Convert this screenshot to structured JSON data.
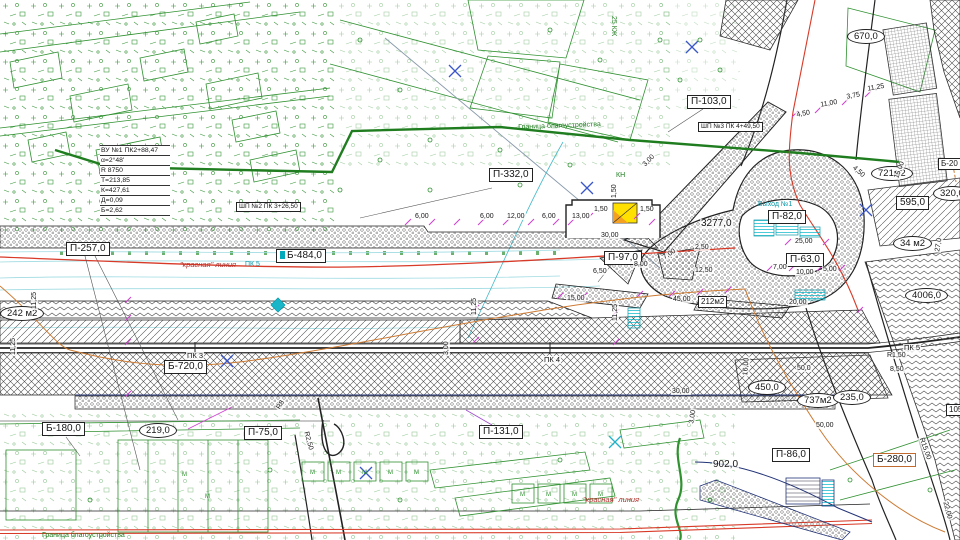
{
  "colors": {
    "survey_green": "#2f9130",
    "red_line": "#d83a28",
    "orange_line": "#cd7a32",
    "magenta_tick": "#d040d0",
    "teal": "#0996a8",
    "navy": "#223377",
    "yellow": "#ffe000"
  },
  "curve_table": {
    "rows": [
      "ВУ №1 ПК2+88,47",
      "α=2°48'",
      "R 8750",
      "Т=213,85",
      "К=427,61",
      "Д=0,09",
      "Б=2,62"
    ]
  },
  "labels": [
    {
      "t": "П-257,0",
      "x": 66,
      "y": 242,
      "c": "boxed"
    },
    {
      "t": "Б-484,0",
      "x": 276,
      "y": 249,
      "c": "boxed flag"
    },
    {
      "t": "П-332,0",
      "x": 489,
      "y": 168,
      "c": "boxed"
    },
    {
      "t": "П-103,0",
      "x": 687,
      "y": 95,
      "c": "boxed"
    },
    {
      "t": "ШП №3 ПК 4+49,50",
      "x": 698,
      "y": 122,
      "c": "boxed tiny"
    },
    {
      "t": "ШП №2 ПК 3+26,50",
      "x": 236,
      "y": 202,
      "c": "boxed tiny"
    },
    {
      "t": "П-82,0",
      "x": 768,
      "y": 210,
      "c": "boxed"
    },
    {
      "t": "П-63,0",
      "x": 786,
      "y": 253,
      "c": "boxed"
    },
    {
      "t": "П-97,0",
      "x": 604,
      "y": 251,
      "c": "boxed"
    },
    {
      "t": "Б-720,0",
      "x": 164,
      "y": 360,
      "c": "boxed"
    },
    {
      "t": "Б-180,0",
      "x": 42,
      "y": 422,
      "c": "boxed"
    },
    {
      "t": "П-75,0",
      "x": 244,
      "y": 426,
      "c": "boxed"
    },
    {
      "t": "П-131,0",
      "x": 479,
      "y": 425,
      "c": "boxed"
    },
    {
      "t": "П-86,0",
      "x": 772,
      "y": 448,
      "c": "boxed"
    },
    {
      "t": "Б-280,0",
      "x": 873,
      "y": 453,
      "c": "boxed ob"
    },
    {
      "t": "595,0",
      "x": 896,
      "y": 196,
      "c": "boxed"
    },
    {
      "t": "212м2",
      "x": 698,
      "y": 296,
      "c": "boxed small"
    },
    {
      "t": "105,0",
      "x": 946,
      "y": 404,
      "c": "boxed small"
    },
    {
      "t": "Б-20",
      "x": 938,
      "y": 158,
      "c": "boxed small"
    },
    {
      "t": "219,0",
      "x": 139,
      "y": 423,
      "c": "ellipse"
    },
    {
      "t": "450,0",
      "x": 748,
      "y": 380,
      "c": "ellipse"
    },
    {
      "t": "737м2",
      "x": 797,
      "y": 393,
      "c": "ellipse"
    },
    {
      "t": "235,0",
      "x": 833,
      "y": 390,
      "c": "ellipse"
    },
    {
      "t": "721м2",
      "x": 871,
      "y": 166,
      "c": "ellipse"
    },
    {
      "t": "34 м2",
      "x": 893,
      "y": 236,
      "c": "ellipse"
    },
    {
      "t": "4006,0",
      "x": 905,
      "y": 288,
      "c": "ellipse"
    },
    {
      "t": "670,0",
      "x": 847,
      "y": 29,
      "c": "ellipse"
    },
    {
      "t": "242 м2",
      "x": 0,
      "y": 306,
      "c": "ellipse"
    },
    {
      "t": "320,0",
      "x": 933,
      "y": 186,
      "c": "ellipse"
    },
    {
      "t": "902,0",
      "x": 712,
      "y": 460,
      "c": "plain strong"
    },
    {
      "t": "3277,0",
      "x": 700,
      "y": 219,
      "c": "plain strong"
    },
    {
      "t": "\"красная\" линия",
      "x": 180,
      "y": 260,
      "c": "redtext"
    },
    {
      "t": "ПК 5",
      "x": 245,
      "y": 260,
      "c": "tealtext"
    },
    {
      "t": "\"красная\" линия",
      "x": 583,
      "y": 495,
      "c": "redtext"
    },
    {
      "t": "Выход №1",
      "x": 758,
      "y": 200,
      "c": "tealtext"
    },
    {
      "t": "КН",
      "x": 616,
      "y": 171,
      "c": "greentext"
    },
    {
      "t": "25 КЖ",
      "x": 618,
      "y": 16,
      "c": "greentext",
      "r": 90
    },
    {
      "t": "Граница благоустройства",
      "x": 518,
      "y": 123,
      "c": "greentext",
      "r": -2
    },
    {
      "t": "Граница благоустройства",
      "x": 42,
      "y": 531,
      "c": "greentext"
    },
    {
      "t": "ПК 3",
      "x": 186,
      "y": 352,
      "c": "station"
    },
    {
      "t": "ПК 4",
      "x": 543,
      "y": 356,
      "c": "station"
    },
    {
      "t": "ПК 5",
      "x": 903,
      "y": 344,
      "c": "station"
    },
    {
      "t": "6,00",
      "x": 414,
      "y": 213,
      "c": "dim"
    },
    {
      "t": "6,00",
      "x": 479,
      "y": 213,
      "c": "dim"
    },
    {
      "t": "12,00",
      "x": 506,
      "y": 213,
      "c": "dim"
    },
    {
      "t": "6,00",
      "x": 541,
      "y": 213,
      "c": "dim"
    },
    {
      "t": "13,00",
      "x": 571,
      "y": 213,
      "c": "dim"
    },
    {
      "t": "1,50",
      "x": 593,
      "y": 206,
      "c": "dim"
    },
    {
      "t": "1,50",
      "x": 639,
      "y": 206,
      "c": "dim"
    },
    {
      "t": "1,50",
      "x": 611,
      "y": 199,
      "c": "dim",
      "r": -90
    },
    {
      "t": "30,00",
      "x": 600,
      "y": 232,
      "c": "dim"
    },
    {
      "t": "45,00",
      "x": 672,
      "y": 296,
      "c": "dim"
    },
    {
      "t": "15,00",
      "x": 566,
      "y": 295,
      "c": "dim"
    },
    {
      "t": "20,00",
      "x": 788,
      "y": 299,
      "c": "dim"
    },
    {
      "t": "12,50",
      "x": 694,
      "y": 267,
      "c": "dim"
    },
    {
      "t": "6,50",
      "x": 592,
      "y": 268,
      "c": "dim"
    },
    {
      "t": "8,00",
      "x": 633,
      "y": 261,
      "c": "dim"
    },
    {
      "t": "7,00",
      "x": 661,
      "y": 256,
      "c": "dim",
      "r": -35
    },
    {
      "t": "2,50",
      "x": 694,
      "y": 244,
      "c": "dim"
    },
    {
      "t": "7,00",
      "x": 772,
      "y": 264,
      "c": "dim"
    },
    {
      "t": "25,00",
      "x": 794,
      "y": 238,
      "c": "dim"
    },
    {
      "t": "10,00",
      "x": 795,
      "y": 269,
      "c": "dim"
    },
    {
      "t": "5,00",
      "x": 822,
      "y": 266,
      "c": "dim"
    },
    {
      "t": "4,50",
      "x": 795,
      "y": 112,
      "c": "dim",
      "r": -10
    },
    {
      "t": "11,00",
      "x": 819,
      "y": 102,
      "c": "dim",
      "r": -10
    },
    {
      "t": "3,75",
      "x": 845,
      "y": 94,
      "c": "dim",
      "r": -10
    },
    {
      "t": "11,25",
      "x": 866,
      "y": 86,
      "c": "dim",
      "r": -10
    },
    {
      "t": "R1,50",
      "x": 886,
      "y": 352,
      "c": "dim"
    },
    {
      "t": "8,50",
      "x": 889,
      "y": 366,
      "c": "dim"
    },
    {
      "t": "R15,00",
      "x": 924,
      "y": 436,
      "c": "dim",
      "r": 70
    },
    {
      "t": "22,00",
      "x": 948,
      "y": 500,
      "c": "dim",
      "r": 75
    },
    {
      "t": "27,0",
      "x": 934,
      "y": 252,
      "c": "dim",
      "r": -80
    },
    {
      "t": "15,00",
      "x": 893,
      "y": 178,
      "c": "dim",
      "r": -70
    },
    {
      "t": "4,50",
      "x": 855,
      "y": 164,
      "c": "dim",
      "r": 42
    },
    {
      "t": "3,00",
      "x": 641,
      "y": 164,
      "c": "dim",
      "r": -46
    },
    {
      "t": "16,00",
      "x": 742,
      "y": 376,
      "c": "dim",
      "r": -85
    },
    {
      "t": "3,00",
      "x": 688,
      "y": 424,
      "c": "dim",
      "r": -80
    },
    {
      "t": "30,00",
      "x": 671,
      "y": 388,
      "c": "dim"
    },
    {
      "t": "50,0",
      "x": 796,
      "y": 365,
      "c": "dim"
    },
    {
      "t": "50,00",
      "x": 815,
      "y": 422,
      "c": "dim"
    },
    {
      "t": "11,25",
      "x": 10,
      "y": 356,
      "c": "dim",
      "r": -90
    },
    {
      "t": "11,25",
      "x": 31,
      "y": 310,
      "c": "dim",
      "r": -90
    },
    {
      "t": "11,25",
      "x": 471,
      "y": 316,
      "c": "dim",
      "r": -90
    },
    {
      "t": "11,25",
      "x": 612,
      "y": 322,
      "c": "dim",
      "r": -90
    },
    {
      "t": "3,00",
      "x": 443,
      "y": 356,
      "c": "dim",
      "r": -90
    },
    {
      "t": "R8",
      "x": 275,
      "y": 408,
      "c": "dim",
      "r": -60
    },
    {
      "t": "R2,50",
      "x": 309,
      "y": 430,
      "c": "dim",
      "r": 75
    },
    {
      "t": "М",
      "x": 310,
      "y": 468,
      "c": "gm"
    },
    {
      "t": "М",
      "x": 336,
      "y": 468,
      "c": "gm"
    },
    {
      "t": "М",
      "x": 362,
      "y": 468,
      "c": "gm"
    },
    {
      "t": "М",
      "x": 388,
      "y": 468,
      "c": "gm"
    },
    {
      "t": "М",
      "x": 414,
      "y": 468,
      "c": "gm"
    },
    {
      "t": "М",
      "x": 520,
      "y": 490,
      "c": "gm"
    },
    {
      "t": "М",
      "x": 546,
      "y": 490,
      "c": "gm"
    },
    {
      "t": "М",
      "x": 572,
      "y": 490,
      "c": "gm"
    },
    {
      "t": "М",
      "x": 598,
      "y": 490,
      "c": "gm"
    },
    {
      "t": "М",
      "x": 182,
      "y": 470,
      "c": "gm"
    },
    {
      "t": "М",
      "x": 205,
      "y": 492,
      "c": "gm"
    }
  ]
}
